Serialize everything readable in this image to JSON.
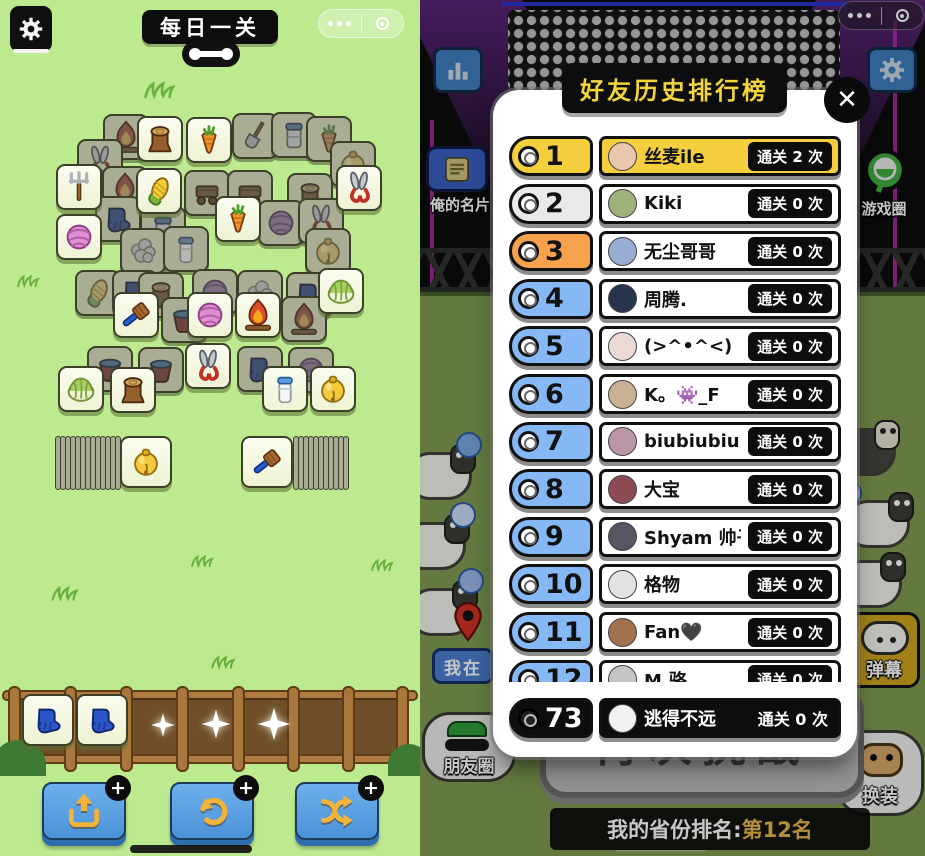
{
  "left_panel": {
    "title": "每日一关",
    "plus_label": "+",
    "board_tiles": [
      {
        "x": 103,
        "y": 114,
        "icon": "fire",
        "state": "dim"
      },
      {
        "x": 232,
        "y": 113,
        "icon": "shovel",
        "state": "dim"
      },
      {
        "x": 271,
        "y": 112,
        "icon": "can",
        "state": "dim"
      },
      {
        "x": 306,
        "y": 116,
        "icon": "carrot",
        "state": "dim"
      },
      {
        "x": 77,
        "y": 139,
        "icon": "scissors",
        "state": "dim"
      },
      {
        "x": 330,
        "y": 141,
        "icon": "bell",
        "state": "dim"
      },
      {
        "x": 102,
        "y": 166,
        "icon": "fire",
        "state": "dim"
      },
      {
        "x": 184,
        "y": 170,
        "icon": "wagon",
        "state": "dim"
      },
      {
        "x": 227,
        "y": 170,
        "icon": "wagon",
        "state": "dim"
      },
      {
        "x": 287,
        "y": 173,
        "icon": "stump",
        "state": "dim"
      },
      {
        "x": 95,
        "y": 196,
        "icon": "glove",
        "state": "dim"
      },
      {
        "x": 140,
        "y": 206,
        "icon": "can",
        "state": "dim"
      },
      {
        "x": 258,
        "y": 200,
        "icon": "yarn_purple",
        "state": "dim"
      },
      {
        "x": 298,
        "y": 198,
        "icon": "scissors",
        "state": "dim"
      },
      {
        "x": 305,
        "y": 228,
        "icon": "bell",
        "state": "dim"
      },
      {
        "x": 120,
        "y": 228,
        "icon": "puff",
        "state": "dim"
      },
      {
        "x": 163,
        "y": 226,
        "icon": "milk",
        "state": "dim"
      },
      {
        "x": 75,
        "y": 270,
        "icon": "corn",
        "state": "dim"
      },
      {
        "x": 112,
        "y": 270,
        "icon": "glove",
        "state": "dim"
      },
      {
        "x": 138,
        "y": 272,
        "icon": "stump",
        "state": "dim"
      },
      {
        "x": 192,
        "y": 269,
        "icon": "yarn_purple",
        "state": "dim"
      },
      {
        "x": 237,
        "y": 270,
        "icon": "puff",
        "state": "dim"
      },
      {
        "x": 286,
        "y": 272,
        "icon": "glove",
        "state": "dim"
      },
      {
        "x": 161,
        "y": 297,
        "icon": "bucket",
        "state": "dim"
      },
      {
        "x": 281,
        "y": 296,
        "icon": "fire",
        "state": "dim"
      },
      {
        "x": 87,
        "y": 346,
        "icon": "bucket",
        "state": "dim"
      },
      {
        "x": 138,
        "y": 347,
        "icon": "bucket",
        "state": "dim"
      },
      {
        "x": 237,
        "y": 346,
        "icon": "glove",
        "state": "dim"
      },
      {
        "x": 288,
        "y": 347,
        "icon": "yarn_purple",
        "state": "dim"
      },
      {
        "x": 137,
        "y": 116,
        "icon": "stump",
        "state": "bright"
      },
      {
        "x": 186,
        "y": 117,
        "icon": "carrot",
        "state": "bright"
      },
      {
        "x": 136,
        "y": 168,
        "icon": "corn",
        "state": "bright"
      },
      {
        "x": 336,
        "y": 165,
        "icon": "scissors",
        "state": "bright"
      },
      {
        "x": 56,
        "y": 164,
        "icon": "fork",
        "state": "bright"
      },
      {
        "x": 56,
        "y": 214,
        "icon": "yarn_pink",
        "state": "bright"
      },
      {
        "x": 215,
        "y": 196,
        "icon": "carrot",
        "state": "bright"
      },
      {
        "x": 318,
        "y": 268,
        "icon": "cabbage",
        "state": "bright"
      },
      {
        "x": 113,
        "y": 292,
        "icon": "brush",
        "state": "bright"
      },
      {
        "x": 187,
        "y": 292,
        "icon": "yarn_pink",
        "state": "bright"
      },
      {
        "x": 235,
        "y": 292,
        "icon": "fire",
        "state": "bright"
      },
      {
        "x": 185,
        "y": 343,
        "icon": "scissors",
        "state": "bright"
      },
      {
        "x": 58,
        "y": 366,
        "icon": "cabbage",
        "state": "bright"
      },
      {
        "x": 110,
        "y": 367,
        "icon": "stump",
        "state": "bright"
      },
      {
        "x": 262,
        "y": 366,
        "icon": "milk",
        "state": "bright"
      },
      {
        "x": 310,
        "y": 366,
        "icon": "bell",
        "state": "bright"
      }
    ],
    "left_stack": {
      "sliver_count": 13,
      "tile_icon": "bell"
    },
    "right_stack": {
      "sliver_count": 11,
      "tile_icon": "brush"
    },
    "tray_tiles": [
      "glove",
      "glove"
    ],
    "action_buttons": [
      {
        "icon": "trayout",
        "name": "move-out-button"
      },
      {
        "icon": "undo",
        "name": "undo-button"
      },
      {
        "icon": "shuffle",
        "name": "shuffle-button"
      }
    ]
  },
  "right_panel": {
    "close_label": "✕",
    "leaderboard": {
      "title": "好友历史排行榜",
      "rows": [
        {
          "rank": "1",
          "name": "丝麦ile",
          "count": "通关 2 次",
          "rank_bg": "#f6cf3e",
          "bar_bg": "#f6cf3e",
          "avatar": "#e9c6ae"
        },
        {
          "rank": "2",
          "name": "Kiki",
          "count": "通关 0 次",
          "rank_bg": "#e9e9e9",
          "bar_bg": "#ffffff",
          "avatar": "#9fb27c"
        },
        {
          "rank": "3",
          "name": "无尘哥哥",
          "count": "通关 0 次",
          "rank_bg": "#f6a14c",
          "bar_bg": "#ffffff",
          "avatar": "#97aed2"
        },
        {
          "rank": "4",
          "name": "周腾.",
          "count": "通关 0 次",
          "rank_bg": "#86b8f6",
          "bar_bg": "#ffffff",
          "avatar": "#26354c"
        },
        {
          "rank": "5",
          "name": "(>^•^<)",
          "count": "通关 0 次",
          "rank_bg": "#86b8f6",
          "bar_bg": "#ffffff",
          "avatar": "#ead9d4"
        },
        {
          "rank": "6",
          "name": "K。👾_F",
          "count": "通关 0 次",
          "rank_bg": "#86b8f6",
          "bar_bg": "#ffffff",
          "avatar": "#c9b193"
        },
        {
          "rank": "7",
          "name": "biubiubiu 👑",
          "count": "通关 0 次",
          "rank_bg": "#86b8f6",
          "bar_bg": "#ffffff",
          "avatar": "#bb95a8"
        },
        {
          "rank": "8",
          "name": "大宝",
          "count": "通关 0 次",
          "rank_bg": "#86b8f6",
          "bar_bg": "#ffffff",
          "avatar": "#8c4a55"
        },
        {
          "rank": "9",
          "name": "Shyam 帅子🌱",
          "count": "通关 0 次",
          "rank_bg": "#86b8f6",
          "bar_bg": "#ffffff",
          "avatar": "#565662"
        },
        {
          "rank": "10",
          "name": "格物",
          "count": "通关 0 次",
          "rank_bg": "#86b8f6",
          "bar_bg": "#ffffff",
          "avatar": "#e2e2e2"
        },
        {
          "rank": "11",
          "name": "Fan🖤",
          "count": "通关 0 次",
          "rank_bg": "#86b8f6",
          "bar_bg": "#ffffff",
          "avatar": "#a2714f"
        },
        {
          "rank": "12",
          "name": "M.骆",
          "count": "通关 0 次",
          "rank_bg": "#86b8f6",
          "bar_bg": "#ffffff",
          "avatar": "#c5c5c5"
        }
      ],
      "me": {
        "rank": "73",
        "name": "逃得不远",
        "count": "通关 0 次"
      }
    },
    "bg_buttons": {
      "card": "俺的名片",
      "game_circle": "游戏圈",
      "location": "我在",
      "moments": "朋友圈",
      "danmaku": "弹幕",
      "outfit": "换装"
    },
    "challenge_label": "再次挑战",
    "province_rank_prefix": "我的省份排名:",
    "province_rank_value": "第12名"
  }
}
